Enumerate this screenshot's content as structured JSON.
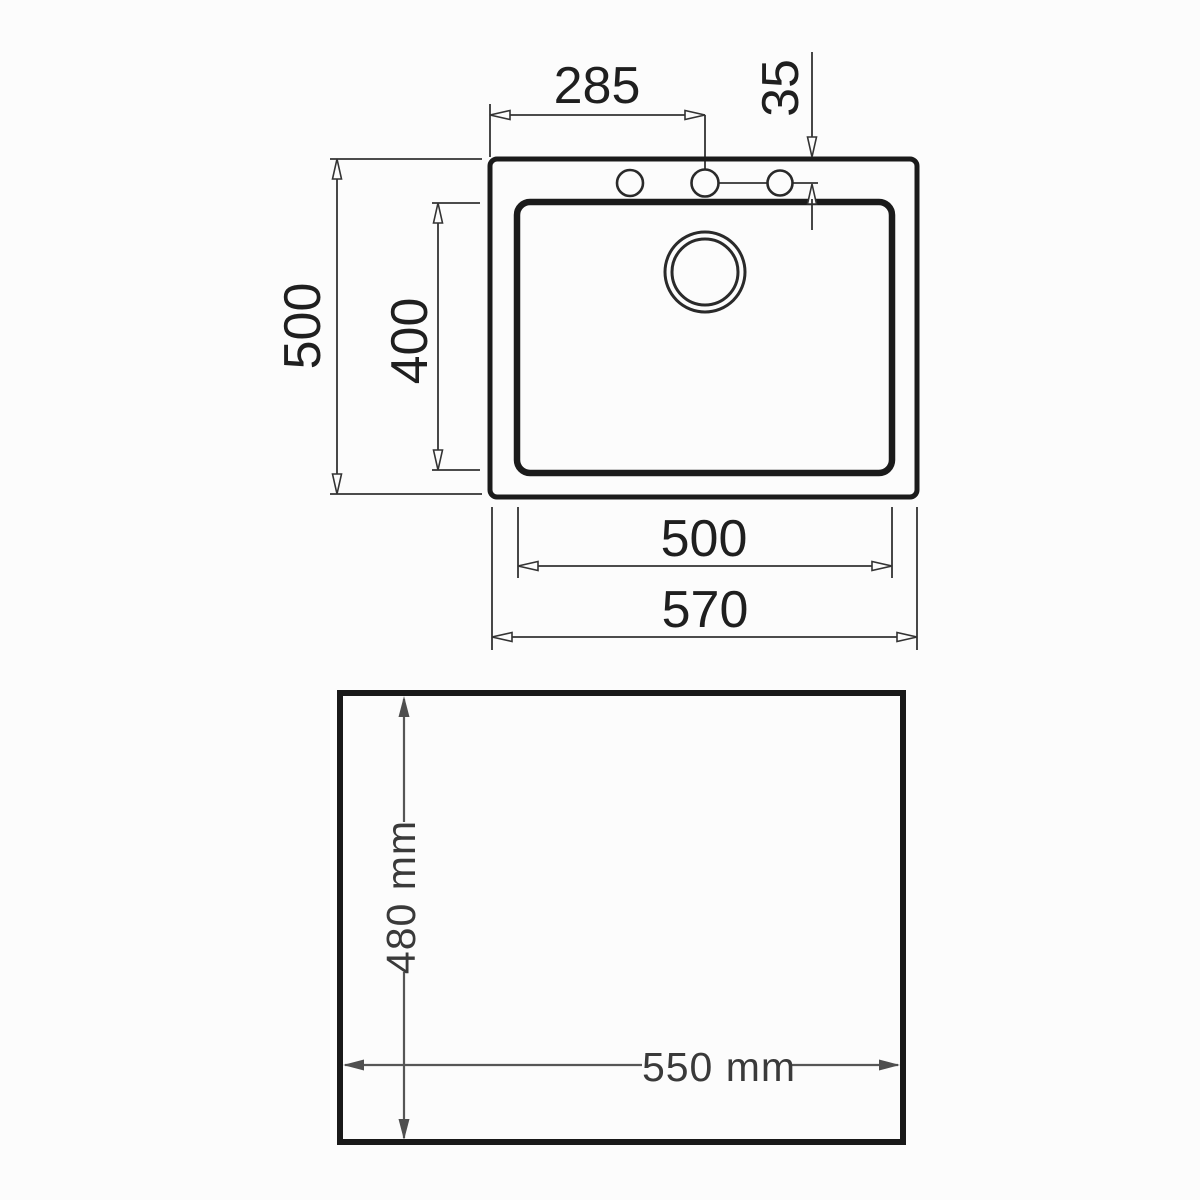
{
  "diagram": {
    "title": "sink-technical-drawing",
    "top_view": {
      "tap_center_offset": "285",
      "tap_edge_offset": "35",
      "overall_depth": "500",
      "bowl_depth": "400",
      "bowl_width": "500",
      "overall_width": "570"
    },
    "cutout_view": {
      "cutout_depth": "480 mm",
      "cutout_width": "550 mm"
    },
    "colors": {
      "background": "#fcfcfc",
      "heavy_outline": "#1b1b1b",
      "dimension_line": "#333333",
      "dimension_text": "#1f1f1f",
      "cutout_outline": "#191919",
      "cutout_dimension_line": "#565656",
      "cutout_text": "#3a3a3a"
    }
  }
}
